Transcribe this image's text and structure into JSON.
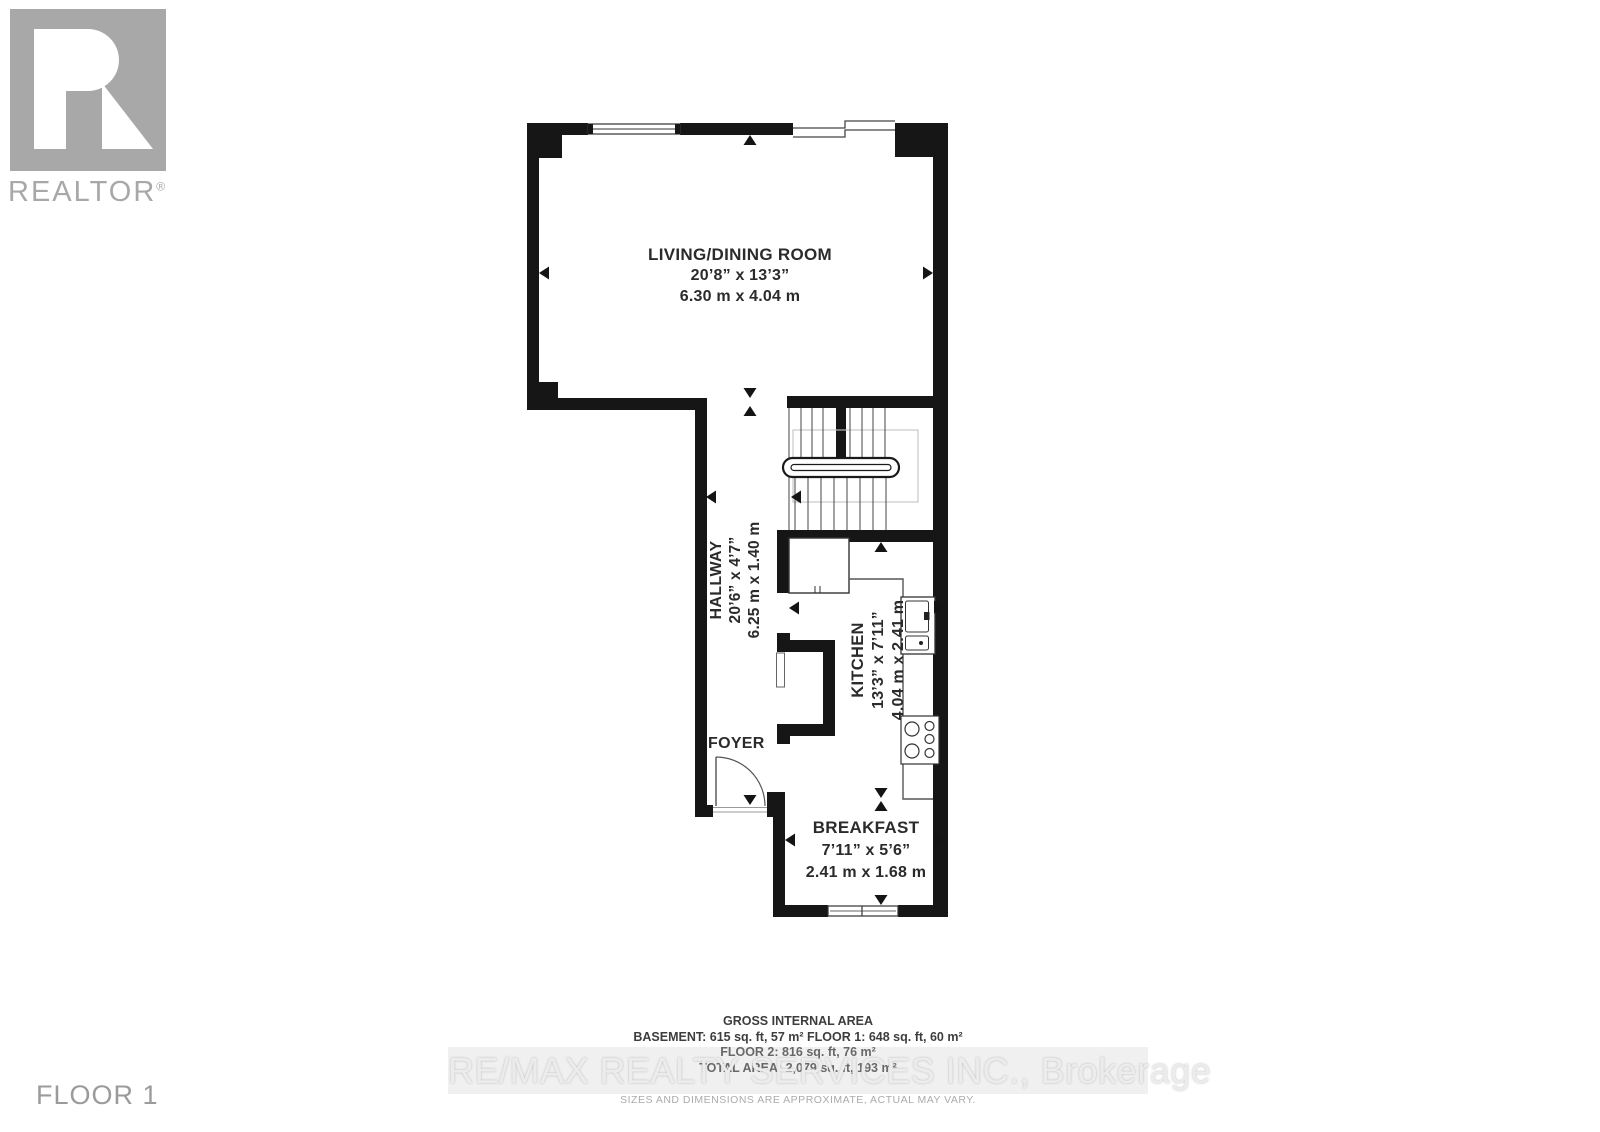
{
  "branding": {
    "wordmark": "REALTOR",
    "reg": "®"
  },
  "floor_label": "FLOOR 1",
  "rooms": {
    "living": {
      "name": "LIVING/DINING ROOM",
      "imperial": "20’8” x 13’3”",
      "metric": "6.30 m x 4.04 m"
    },
    "hallway": {
      "name": "HALLWAY",
      "imperial": "20’6” x 4’7”",
      "metric": "6.25 m x 1.40 m"
    },
    "kitchen": {
      "name": "KITCHEN",
      "imperial": "13’3” x 7’11”",
      "metric": "4.04 m x 2.41 m"
    },
    "foyer": {
      "name": "FOYER"
    },
    "breakfast": {
      "name": "BREAKFAST",
      "imperial": "7’11” x 5’6”",
      "metric": "2.41 m x 1.68 m"
    }
  },
  "area_summary": {
    "title": "GROSS INTERNAL AREA",
    "basement_floor1": "BASEMENT: 615 sq. ft, 57 m² FLOOR 1: 648 sq. ft, 60 m²",
    "floor2": "FLOOR 2: 816 sq. ft, 76 m²",
    "total": "TOTAL AREA: 2,079 sq. ft, 193 m²"
  },
  "watermark": "RE/MAX REALTY SERVICES INC., Brokerage",
  "disclaimer": "SIZES AND DIMENSIONS ARE APPROXIMATE, ACTUAL MAY VARY.",
  "colors": {
    "wall": "#161616",
    "line": "#555555",
    "gray_text": "#9b9b9b",
    "logo_gray": "#a8a8a8"
  }
}
